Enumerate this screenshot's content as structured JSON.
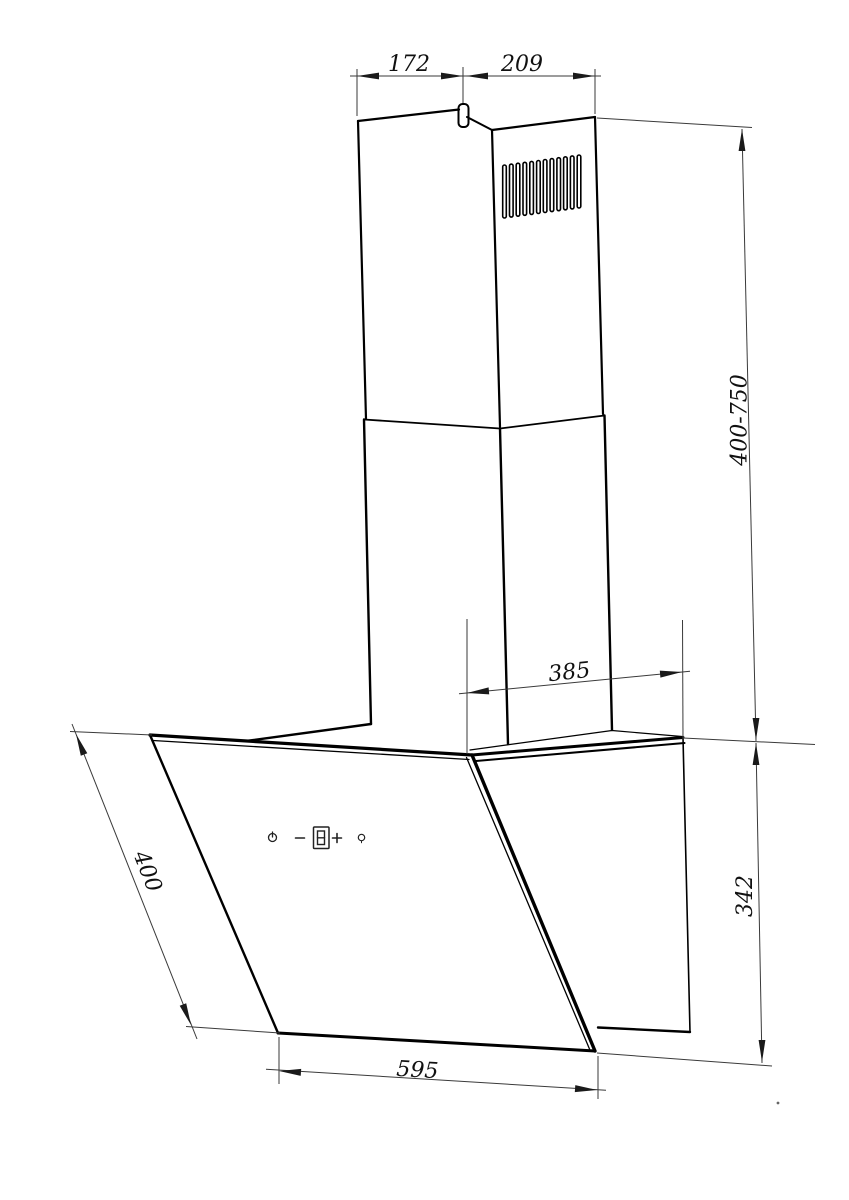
{
  "canvas": {
    "background": "#ffffff",
    "line_color": "#000000",
    "dimension_line_color": "#3a3a3a",
    "text_color": "#111111"
  },
  "dimensions": {
    "chimney_top_left_width": "172",
    "chimney_top_right_width": "209",
    "chimney_height_range": "400-750",
    "top_depth": "385",
    "body_side_height": "342",
    "glass_panel_length": "400",
    "bottom_width": "595"
  },
  "control_panel": {
    "display_value": "8",
    "icons": [
      "power-icon",
      "minus-icon",
      "speed-display",
      "plus-icon",
      "light-icon"
    ]
  }
}
